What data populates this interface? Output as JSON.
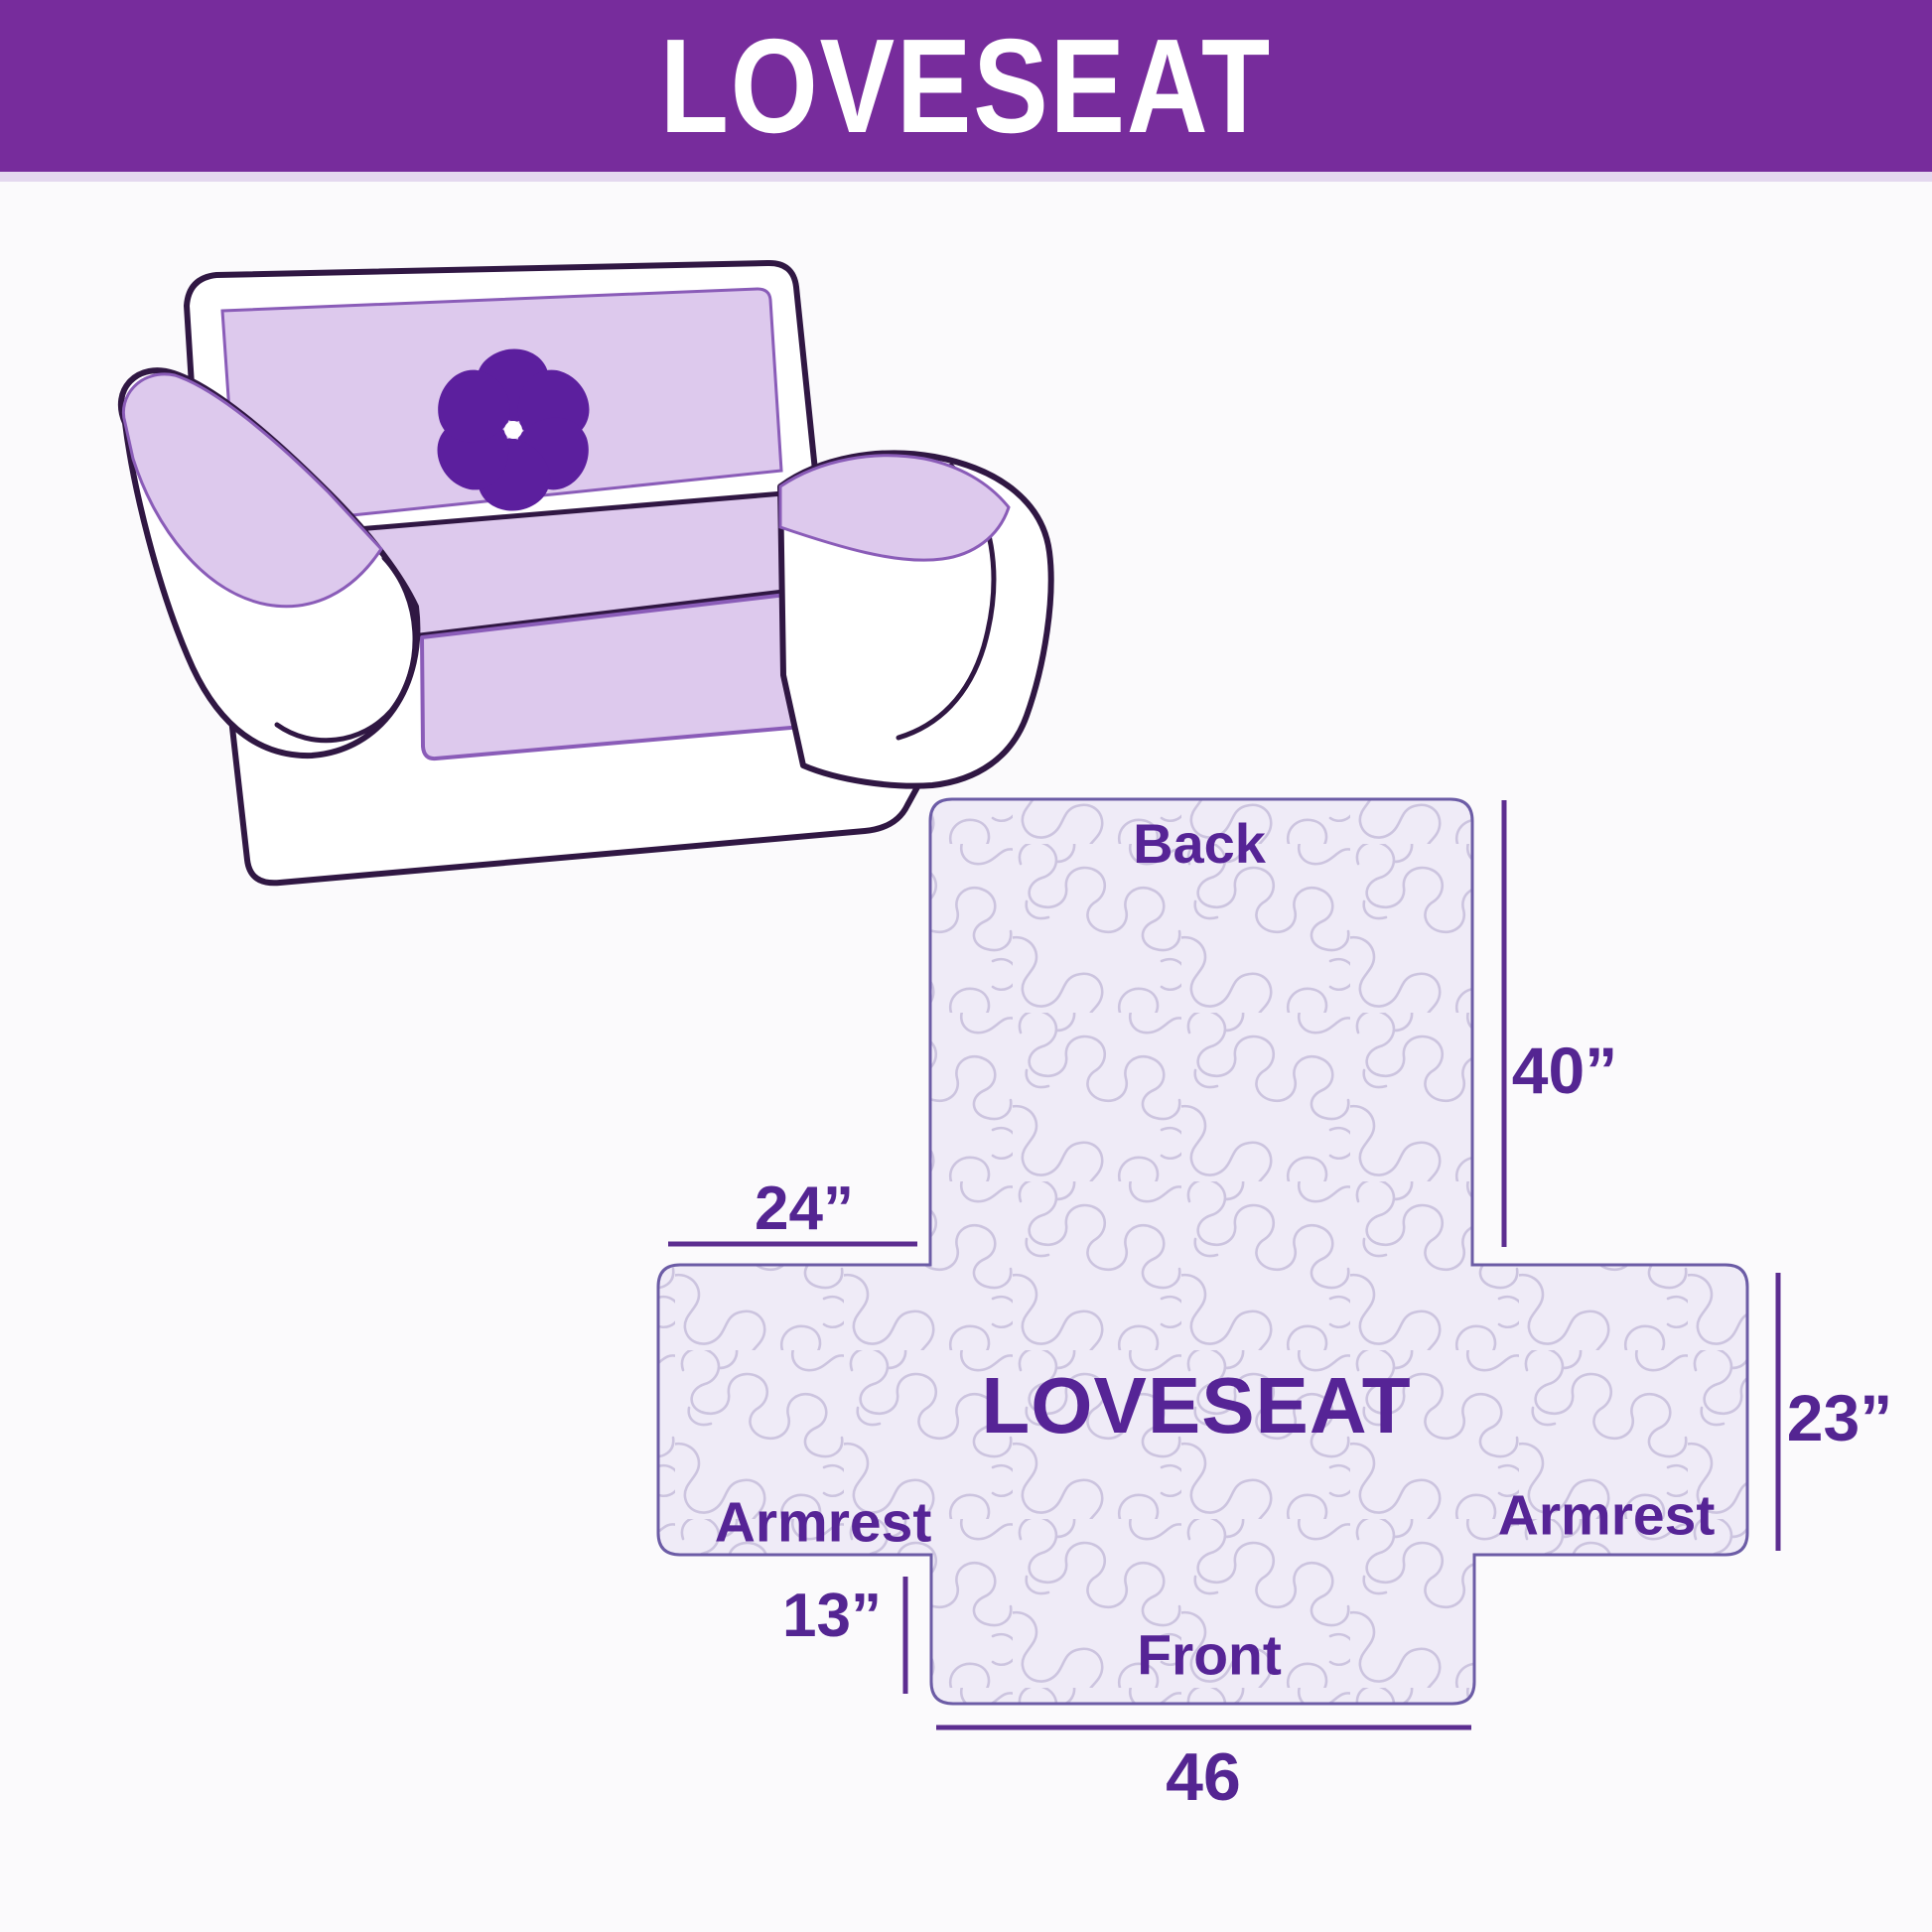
{
  "header": {
    "title": "LOVESEAT",
    "bg_color": "#772C9C",
    "text_color": "#FFFFFF"
  },
  "illustration": {
    "description": "line drawing of a two-seat loveseat with quilted furniture cover draped over back, seat and armrests",
    "cover_color": "#DDC9ED",
    "outline_color": "#301743",
    "cover_edge_color": "#8A5CB8",
    "logo": "pinwheel-icon",
    "logo_color": "#5C1F9E"
  },
  "diagram": {
    "product_label": "LOVESEAT",
    "panels": {
      "back": "Back",
      "front": "Front",
      "armrest_left": "Armrest",
      "armrest_right": "Armrest"
    },
    "dimensions": {
      "back_height": "40”",
      "armrest_top_width": "24”",
      "side_height": "23”",
      "front_height": "13”",
      "front_width": "46"
    },
    "fill_color": "#EFEBF7",
    "pattern_color": "#CCC4DF",
    "border_color": "#6C5CA6",
    "dimension_line_color": "#5C2D90",
    "label_color": "#562496"
  }
}
